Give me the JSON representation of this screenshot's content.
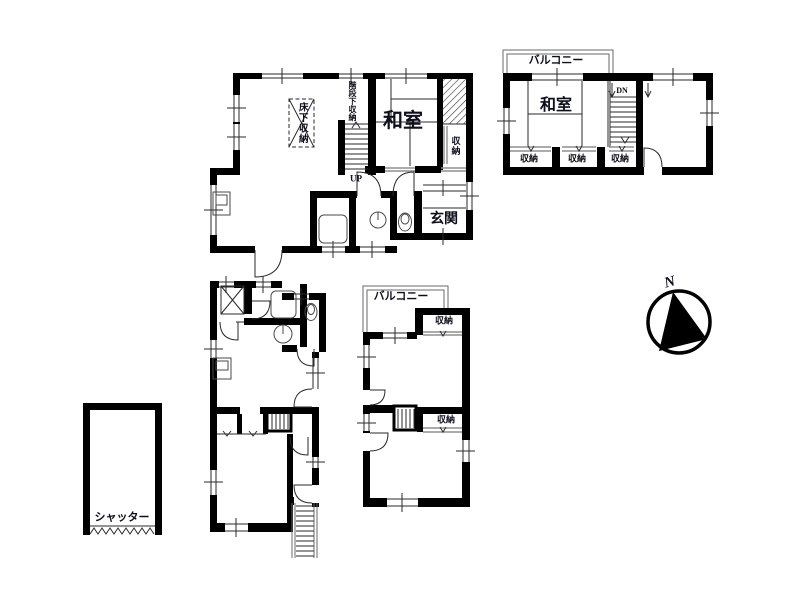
{
  "colors": {
    "wall": "#000000",
    "line": "#2a2a2a",
    "sliding_door": "#8f8f8f",
    "text": "#0e0e1c",
    "background": "#ffffff"
  },
  "floor1": {
    "labels": {
      "floor_storage": "床下収納",
      "under_stair_storage": "階段下収納",
      "stairs_up": "UP",
      "japanese_room": "和室",
      "storage": "収納",
      "entrance": "玄関"
    }
  },
  "floor2": {
    "labels": {
      "balcony": "バルコニー",
      "japanese_room": "和室",
      "stairs_down": "DN",
      "storage_left": "収納",
      "storage_center": "収納",
      "storage_right": "収納"
    }
  },
  "annex": {
    "labels": {
      "balcony": "バルコニー",
      "storage_upper": "収納",
      "storage_lower": "収納"
    }
  },
  "garage": {
    "labels": {
      "shutter": "シャッター"
    }
  },
  "compass": {
    "north": "N"
  }
}
